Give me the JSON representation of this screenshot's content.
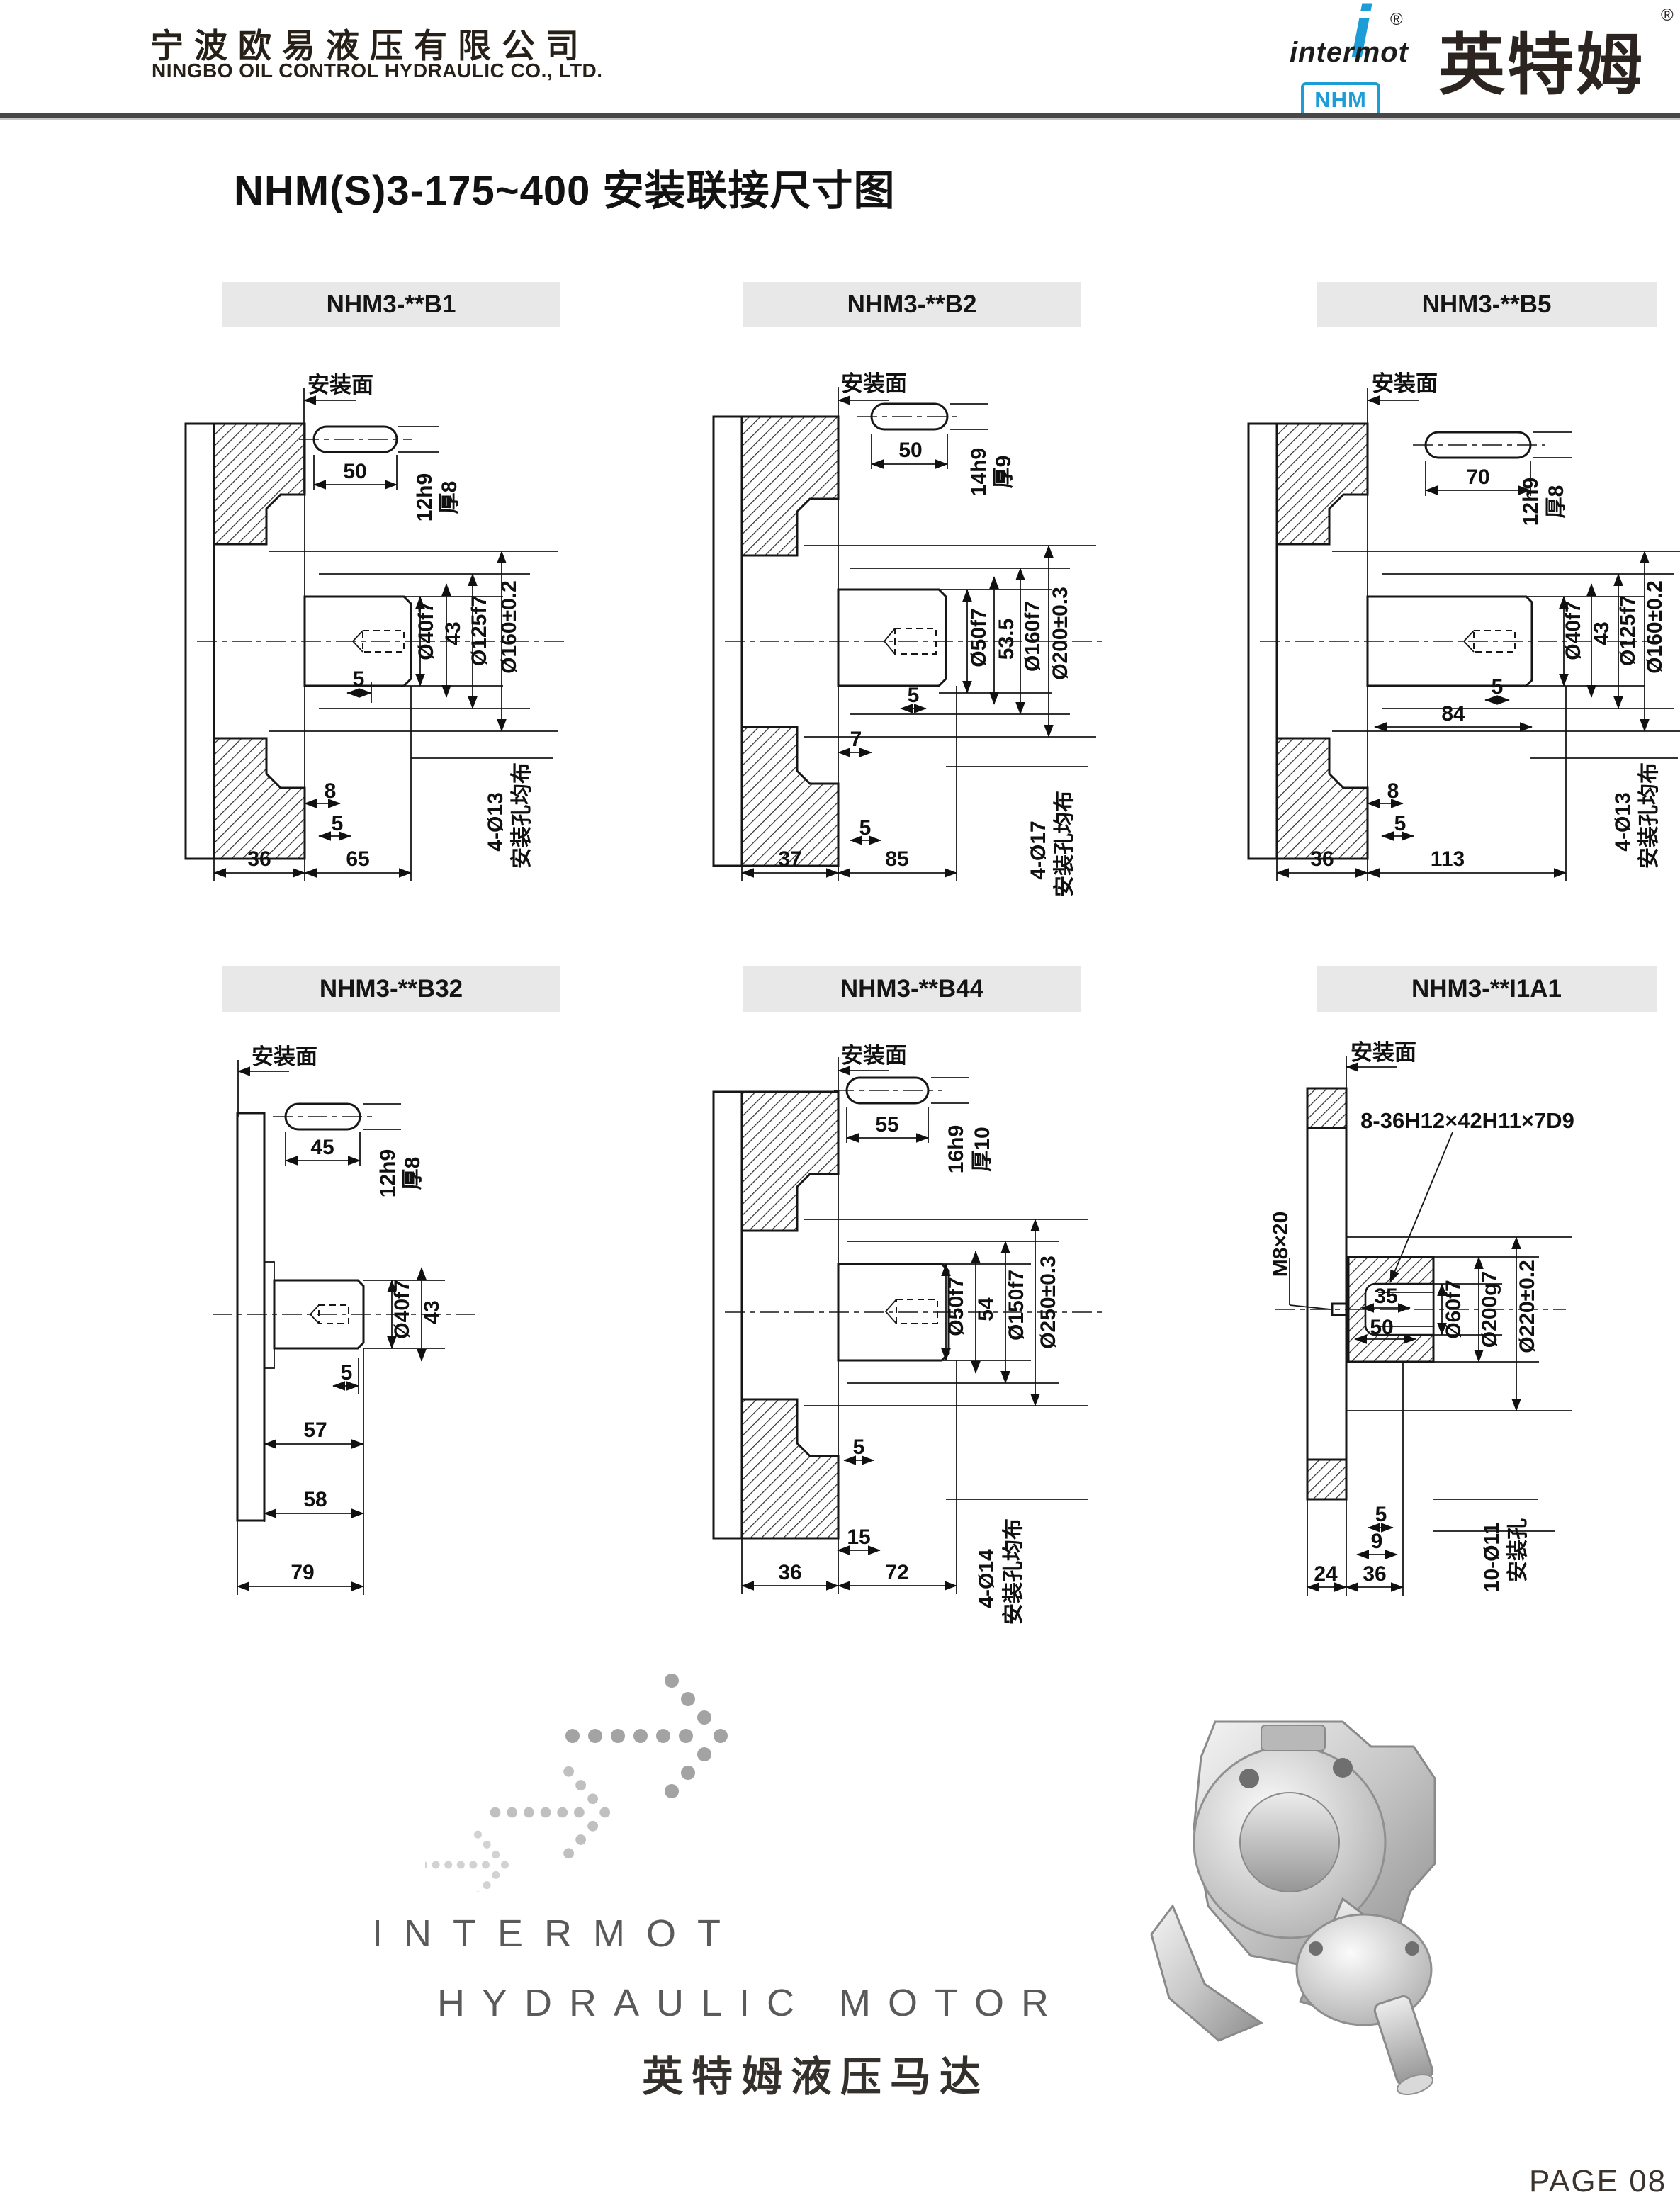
{
  "header": {
    "company_cn": "宁波欧易液压有限公司",
    "company_en": "NINGBO OIL CONTROL HYDRAULIC CO., LTD.",
    "logo": {
      "brand": "intermot",
      "brand_i": "i",
      "reg": "®",
      "badge": "NHM",
      "brand_cn": "英特姆",
      "reg2": "®",
      "accent_color": "#1d9dd8"
    }
  },
  "title": "NHM(S)3-175~400  安装联接尺寸图",
  "drawings": [
    {
      "model": "NHM3-**B1",
      "mount_face": "安装面",
      "key": [
        "50",
        "12h9",
        "厚8"
      ],
      "radial": [
        "Ø40f7",
        "43",
        "Ø125f7",
        "Ø160±0.2"
      ],
      "axial": [
        "5",
        "8",
        "5",
        "36",
        "65"
      ],
      "holes": [
        "4-Ø13",
        "安装孔均布"
      ]
    },
    {
      "model": "NHM3-**B2",
      "mount_face": "安装面",
      "key": [
        "50",
        "14h9",
        "厚9"
      ],
      "radial": [
        "Ø50f7",
        "53.5",
        "Ø160f7",
        "Ø200±0.3"
      ],
      "axial": [
        "5",
        "7",
        "5",
        "37",
        "85"
      ],
      "holes": [
        "4-Ø17",
        "安装孔均布"
      ]
    },
    {
      "model": "NHM3-**B5",
      "mount_face": "安装面",
      "key": [
        "70",
        "12h9",
        "厚8"
      ],
      "radial": [
        "Ø40f7",
        "43",
        "Ø125f7",
        "Ø160±0.2"
      ],
      "axial": [
        "5",
        "84",
        "8",
        "5",
        "36",
        "113"
      ],
      "holes": [
        "4-Ø13",
        "安装孔均布"
      ]
    },
    {
      "model": "NHM3-**B32",
      "mount_face": "安装面",
      "key": [
        "45",
        "12h9",
        "厚8"
      ],
      "radial": [
        "Ø40f7",
        "43"
      ],
      "axial": [
        "5",
        "57",
        "58",
        "79"
      ],
      "holes": []
    },
    {
      "model": "NHM3-**B44",
      "mount_face": "安装面",
      "key": [
        "55",
        "16h9",
        "厚10"
      ],
      "radial": [
        "Ø50f7",
        "54",
        "Ø150f7",
        "Ø250±0.3"
      ],
      "axial": [
        "5",
        "15",
        "36",
        "72"
      ],
      "holes": [
        "4-Ø14",
        "安装孔均布"
      ]
    },
    {
      "model": "NHM3-**I1A1",
      "mount_face": "安装面",
      "spline": "8-36H12×42H11×7D9",
      "socket": [
        "35",
        "50"
      ],
      "radial": [
        "Ø60f7",
        "Ø200g7",
        "Ø220±0.2"
      ],
      "side_thread": "M8×20",
      "axial": [
        "5",
        "9",
        "24",
        "36"
      ],
      "holes": [
        "10-Ø11",
        "安装孔"
      ]
    }
  ],
  "footer": {
    "slogan1": "INTERMOT",
    "slogan2": "HYDRAULIC MOTOR",
    "slogan_cn": "英特姆液压马达",
    "page": "PAGE 08"
  }
}
